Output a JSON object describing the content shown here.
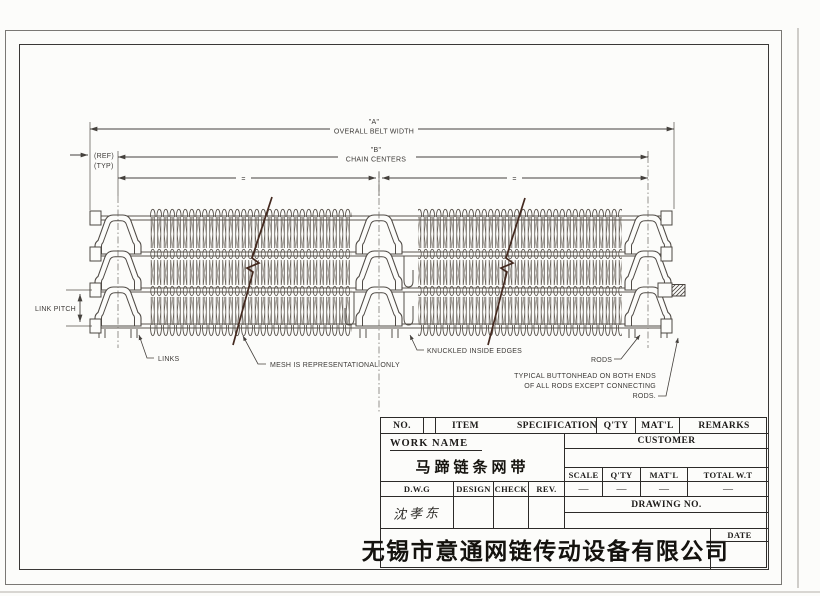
{
  "drawing": {
    "dim_a": "\"A\"",
    "dim_a_sub": "OVERALL BELT WIDTH",
    "dim_b": "\"B\"",
    "dim_b_sub": "CHAIN CENTERS",
    "ref": "(REF)",
    "typ": "(TYP)",
    "eq_left": "=",
    "eq_right": "=",
    "link_pitch": "LINK PITCH",
    "links": "LINKS",
    "mesh_note": "MESH IS REPRESENTATIONAL ONLY",
    "knuckled": "KNUCKLED INSIDE EDGES",
    "rods": "RODS",
    "buttonhead_1": "TYPICAL BUTTONHEAD ON BOTH ENDS",
    "buttonhead_2": "OF ALL RODS EXCEPT CONNECTING",
    "buttonhead_3": "RODS."
  },
  "title_block": {
    "no": "NO.",
    "item": "ITEM",
    "specification": "SPECIFICATION",
    "qty": "Q'TY",
    "matl": "MAT'L",
    "remarks": "REMARKS",
    "work_name_label": "WORK NAME",
    "work_name": "马蹄链条网带",
    "customer_label": "CUSTOMER",
    "scale_label": "SCALE",
    "qty2_label": "Q'TY",
    "matl2_label": "MAT'L",
    "total_wt_label": "TOTAL W.T",
    "scale_value": "—",
    "qty2_value": "—",
    "matl2_value": "—",
    "total_wt_value": "—",
    "dwg_label": "D.W.G",
    "design_label": "DESIGN",
    "check_label": "CHECK",
    "rev_label": "REV.",
    "dwg_signature": "沈孝东",
    "drawing_no_label": "DRAWING NO.",
    "date_label": "DATE",
    "company": "无锡市意通网链传动设备有限公司"
  }
}
